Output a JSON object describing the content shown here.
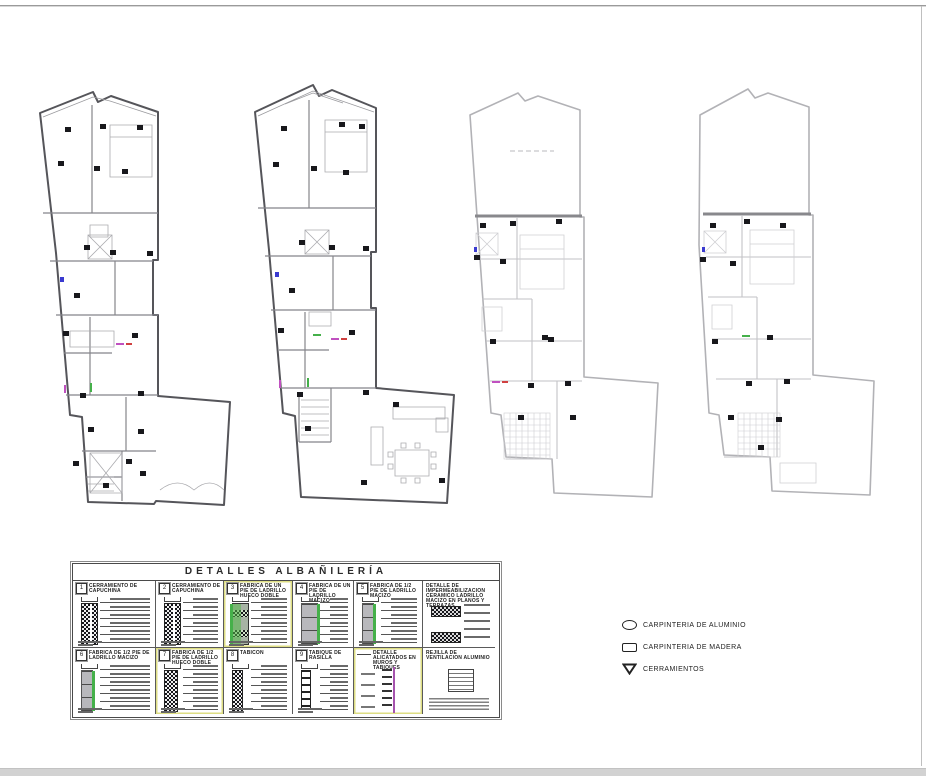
{
  "details_table": {
    "title": "DETALLES ALBAÑILERÍA",
    "row1": [
      {
        "num": "1",
        "label": "CERRAMIENTO DE CAPUCHINA"
      },
      {
        "num": "2",
        "label": "CERRAMIENTO DE CAPUCHINA"
      },
      {
        "num": "3",
        "label": "FABRICA DE UN PIE DE LADRILLO HUECO DOBLE"
      },
      {
        "num": "4",
        "label": "FABRICA DE UN PIE DE LADRILLO MACIZO"
      },
      {
        "num": "5",
        "label": "FABRICA DE 1/2 PIE DE LADRILLO MACIZO"
      },
      {
        "num": "",
        "label": "DETALLE DE IMPERMEABILIZACION CERAMICO LADRILLO MACIZO EN PLANOS Y TERRAZAS"
      }
    ],
    "row2": [
      {
        "num": "6",
        "label": "FABRICA DE 1/2 PIE DE LADRILLO MACIZO"
      },
      {
        "num": "7",
        "label": "FABRICA DE 1/2 PIE DE LADRILLO HUECO DOBLE"
      },
      {
        "num": "8",
        "label": "TABICON"
      },
      {
        "num": "9",
        "label": "TABIQUE DE RASILLA"
      },
      {
        "num": "",
        "label": "DETALLE ALICATADOS EN MUROS Y TABIQUES"
      },
      {
        "num": "",
        "label": "REJILLA DE VENTILACION ALUMINIO"
      }
    ]
  },
  "legend": {
    "items": [
      {
        "icon": "ellipse-icon",
        "label": "CARPINTERIA DE ALUMINIO"
      },
      {
        "icon": "rect-icon",
        "label": "CARPINTERIA DE MADERA"
      },
      {
        "icon": "triangle-icon",
        "label": "CERRAMIENTOS"
      }
    ]
  },
  "colors": {
    "plan_dark": "#55555a",
    "plan_light": "#b2b2b6",
    "accent_green": "#45b04a",
    "accent_yellow": "#dede84",
    "accent_magenta": "#a653ae",
    "marker_black": "#18181c"
  }
}
